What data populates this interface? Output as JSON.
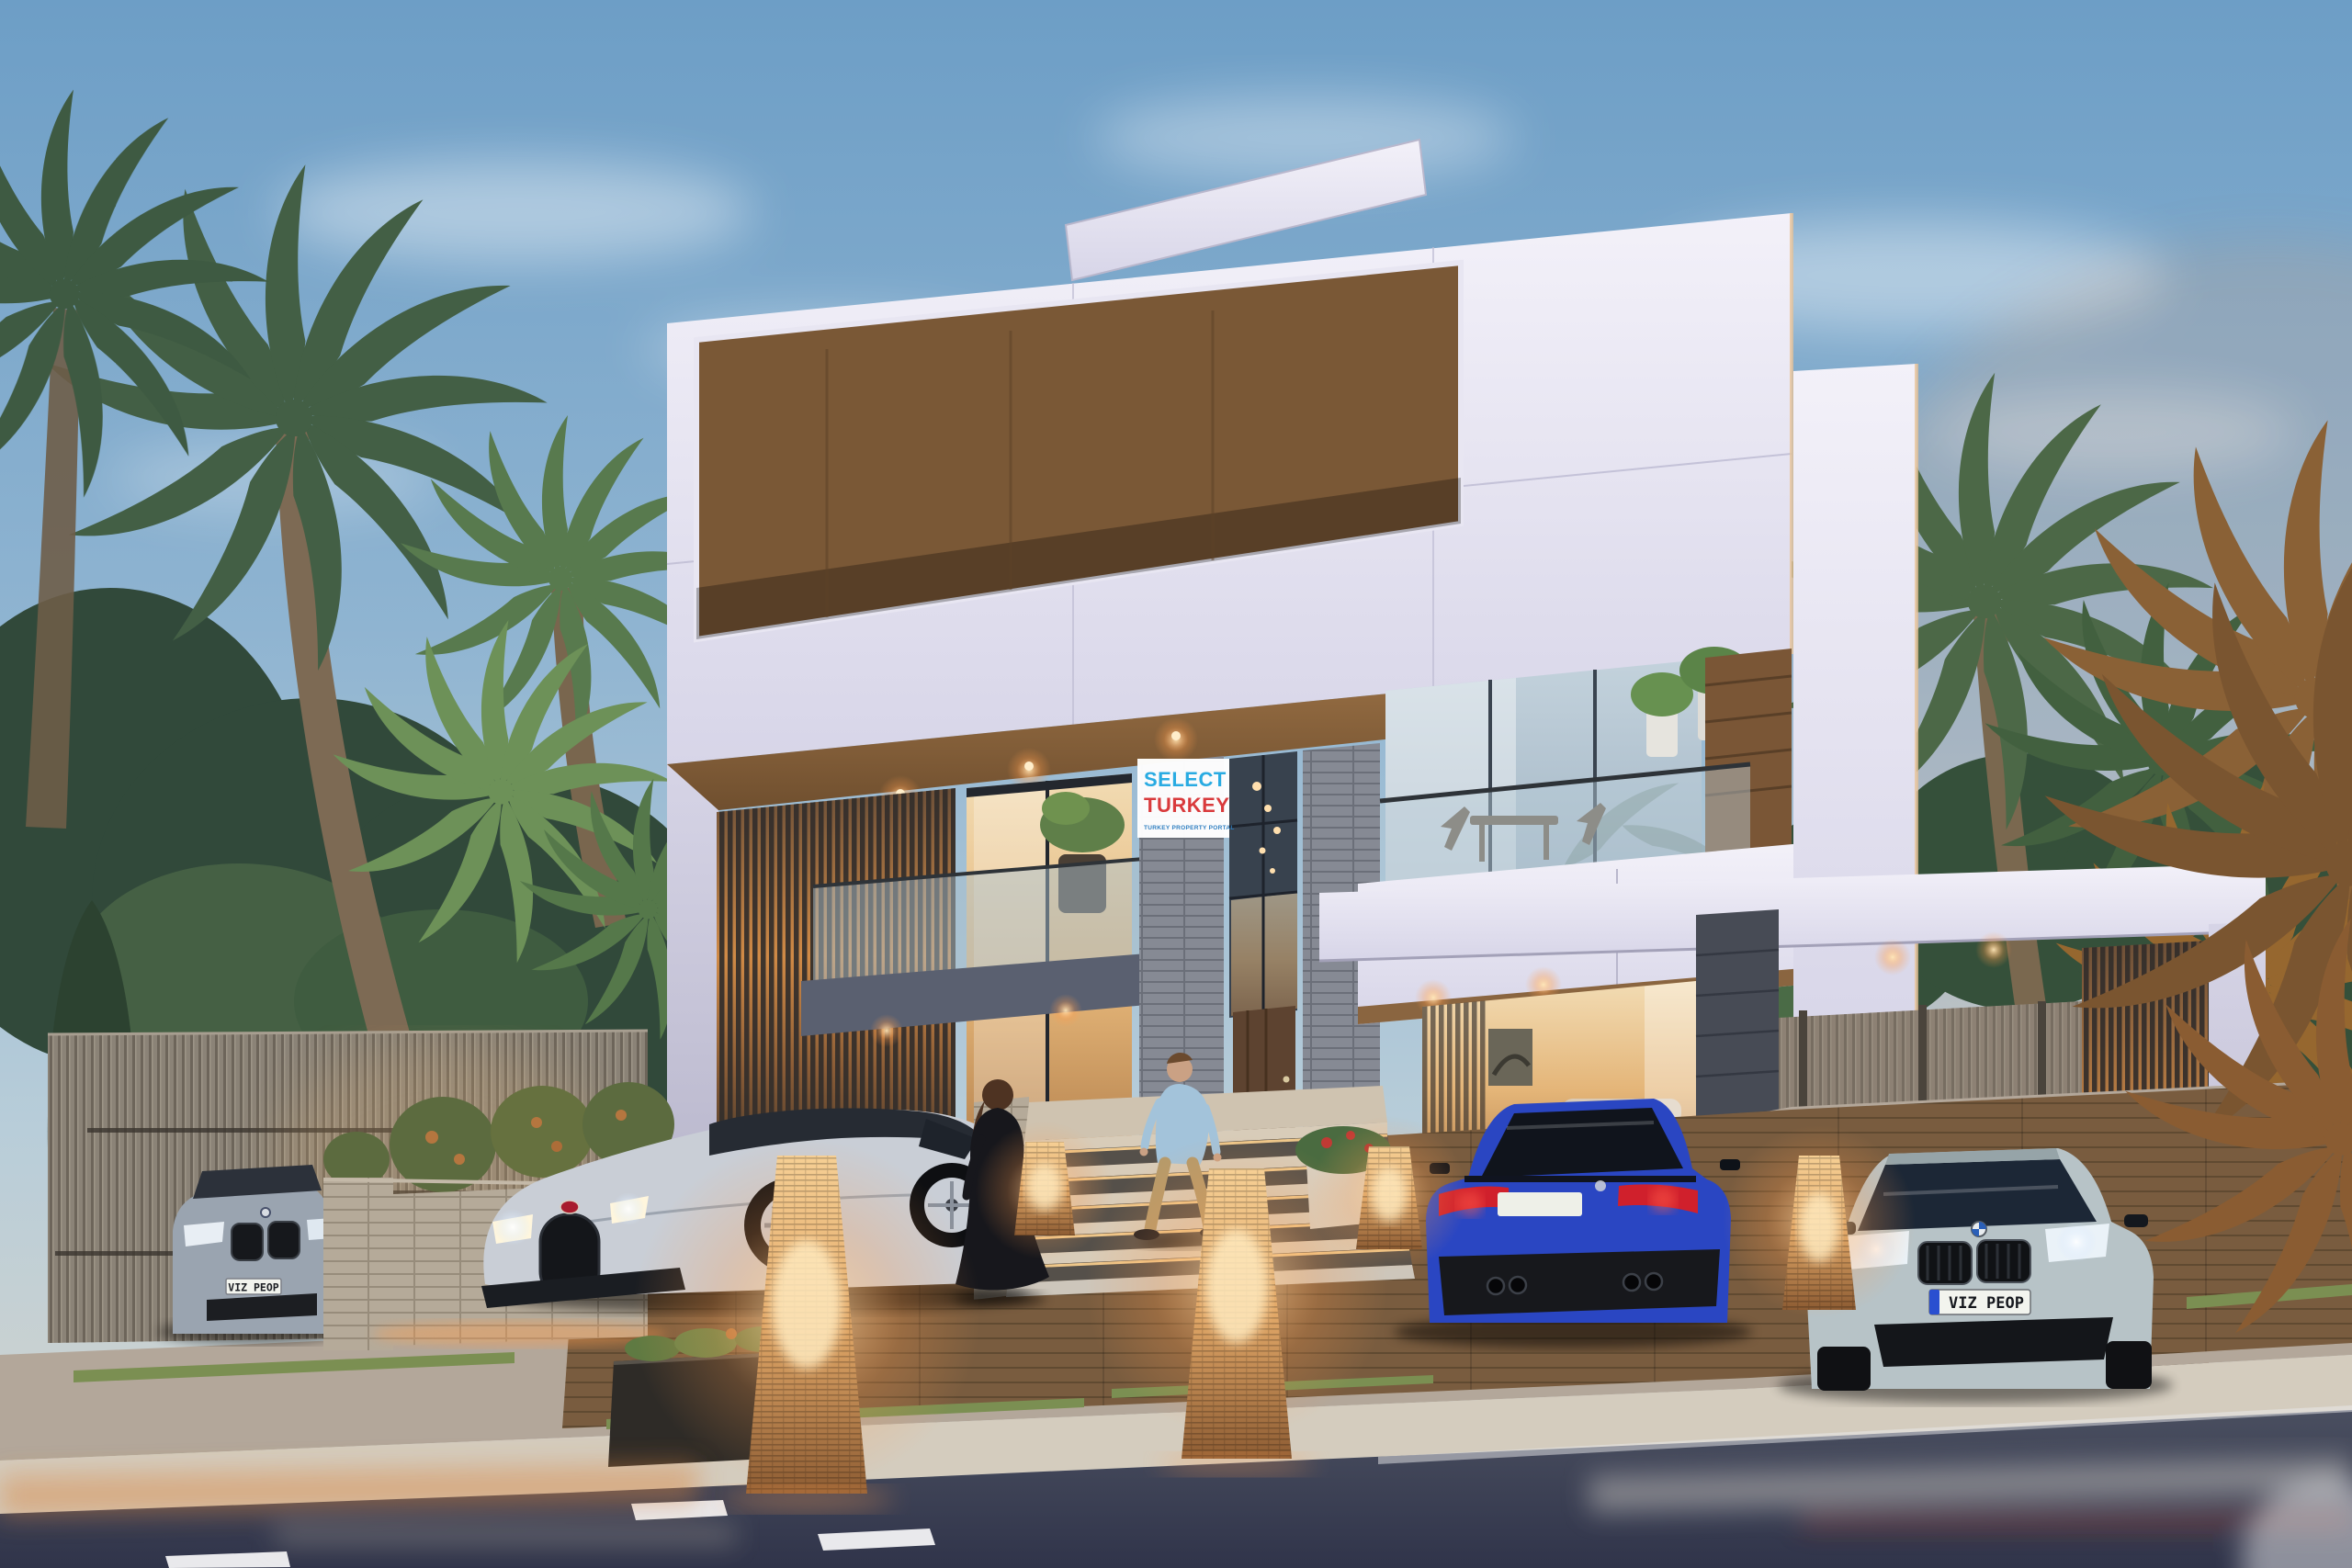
{
  "scene": {
    "type": "architectural-render",
    "description": "Modern three-storey luxury villa at dusk with palm garden, designer wicker lamps, driveway, carport and street",
    "watermark_sign": {
      "line1": "SELECT",
      "line2": "TURKEY",
      "line3": "TURKEY PROPERTY PORTAL",
      "line1_color": "#29abe2",
      "line2_color": "#d93a3c",
      "line3_color": "#2f7fc1",
      "background": "#ffffff"
    },
    "license_plates": {
      "left_parked_car": "VIZ PEOP",
      "carport_car": "VIZ PEOP",
      "blue_car": "",
      "plate_background": "#f2f4ee",
      "eu_band": "#2a4fd0"
    },
    "vehicles": [
      {
        "name": "silver-hypercar",
        "color": "#c9ced6"
      },
      {
        "name": "blue-sports-coupe",
        "color": "#2a46c2"
      },
      {
        "name": "silver-gran-coupe",
        "color": "#b7c3c7"
      },
      {
        "name": "grey-coupe",
        "color": "#9aa4b0"
      }
    ],
    "people": [
      {
        "name": "woman-in-black-dress",
        "dress_color": "#17171c"
      },
      {
        "name": "man-in-denim-shirt",
        "shirt_color": "#a3c3da",
        "pants_color": "#b59a6a"
      }
    ],
    "palette": {
      "sky_top": "#6d9ec6",
      "sky_horizon": "#d8d5cb",
      "villa_white": "#efedf7",
      "villa_shade": "#c9c7da",
      "soffit_wood": "#8a6540",
      "stone_pier": "#868a94",
      "louver_glow": "#d08a46",
      "glass_warm": "#e4b578",
      "glass_cool": "#a9bccb",
      "fence_wood": "#8b8377",
      "planter_stone": "#a89d90",
      "deck_wood": "#8a6a48",
      "pavement": "#b3a79a",
      "sidewalk": "#d4ccbe",
      "road": "#3e4250",
      "road_marking": "#e9e9ec",
      "lamp_glow": "#ffc478",
      "palm_green": "#4c6847",
      "palm_warm": "#96672f",
      "foliage_dark": "#31493a",
      "taillight": "#d0202c",
      "headlight": "#fff3d4"
    }
  }
}
